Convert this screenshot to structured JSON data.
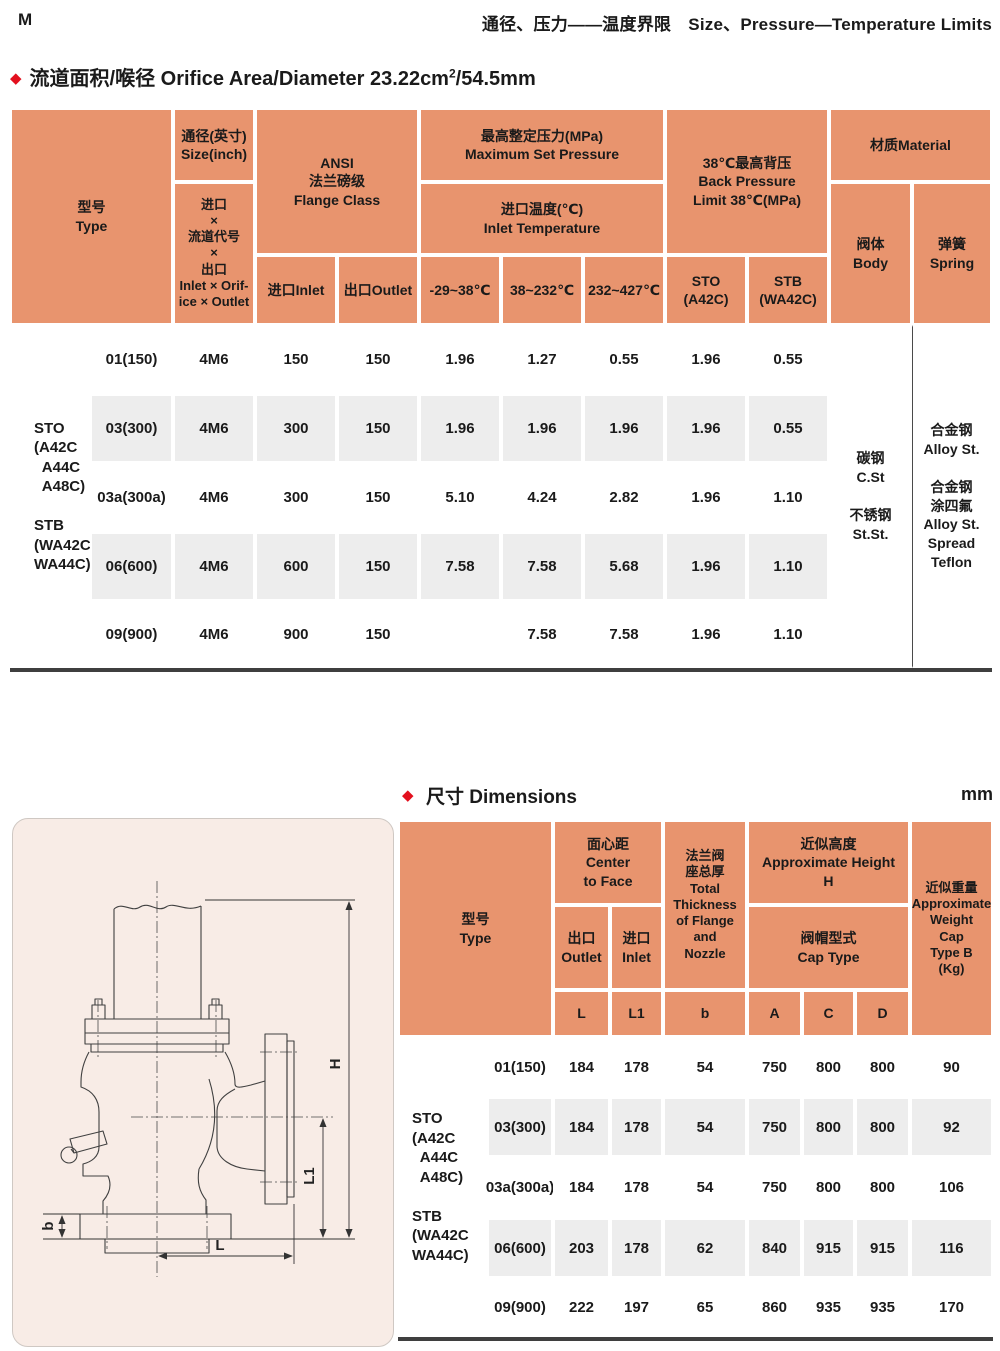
{
  "page": {
    "corner_mark": "M",
    "header_title": "通径、压力——温度界限　Size、Pressure—Temperature Limits"
  },
  "section1": {
    "title_main": "流道面积/喉径 Orifice Area/Diameter 23.22cm",
    "title_sup": "2",
    "title_suffix": "/54.5mm"
  },
  "section2": {
    "title": "尺寸 Dimensions",
    "unit": "mm"
  },
  "colors": {
    "table_header_bg": "#e8946e",
    "row_stripe": "#ededed",
    "accent_red": "#e3101e",
    "panel_bg": "#f8ece6",
    "rule_dark": "#3f3f3f"
  },
  "table1": {
    "headers": {
      "type": "型号\nType",
      "size_top": "通径(英寸)\nSize(inch)",
      "size_bottom": "进口\n×\n流道代号\n×\n出口\nInlet × Orif-\nice × Outlet",
      "ansi": "ANSI\n法兰磅级\nFlange Class",
      "inlet": "进口Inlet",
      "outlet": "出口Outlet",
      "max_set": "最高整定压力(MPa)\nMaximum Set Pressure",
      "inlet_temp": "进口温度(℃)\nInlet Temperature",
      "temp1": "-29~38℃",
      "temp2": "38~232℃",
      "temp3": "232~427℃",
      "back_pressure": "38℃最高背压\nBack Pressure\nLimit 38℃(MPa)",
      "sto": "STO\n(A42C)",
      "stb": "STB\n(WA42C)",
      "material": "材质Material",
      "body": "阀体\nBody",
      "spring": "弹簧\nSpring"
    },
    "side_label": "STO\n(A42C\n  A44C\n  A48C)\n\nSTB\n(WA42C\nWA44C)",
    "body_material": "碳钢\nC.St\n\n不锈钢\nSt.St.",
    "spring_material": "合金钢\nAlloy St.\n\n合金钢\n涂四氟\nAlloy St.\nSpread\nTeflon",
    "rows": [
      {
        "type": "01(150)",
        "size": "4M6",
        "inlet": "150",
        "outlet": "150",
        "t1": "1.96",
        "t2": "1.27",
        "t3": "0.55",
        "sto": "1.96",
        "stb": "0.55"
      },
      {
        "type": "03(300)",
        "size": "4M6",
        "inlet": "300",
        "outlet": "150",
        "t1": "1.96",
        "t2": "1.96",
        "t3": "1.96",
        "sto": "1.96",
        "stb": "0.55"
      },
      {
        "type": "03a(300a)",
        "size": "4M6",
        "inlet": "300",
        "outlet": "150",
        "t1": "5.10",
        "t2": "4.24",
        "t3": "2.82",
        "sto": "1.96",
        "stb": "1.10"
      },
      {
        "type": "06(600)",
        "size": "4M6",
        "inlet": "600",
        "outlet": "150",
        "t1": "7.58",
        "t2": "7.58",
        "t3": "5.68",
        "sto": "1.96",
        "stb": "1.10"
      },
      {
        "type": "09(900)",
        "size": "4M6",
        "inlet": "900",
        "outlet": "150",
        "t1": "",
        "t2": "7.58",
        "t3": "7.58",
        "sto": "1.96",
        "stb": "1.10"
      }
    ]
  },
  "table2": {
    "headers": {
      "type": "型号\nType",
      "center_to_face": "面心距\nCenter\nto Face",
      "outlet": "出口\nOutlet",
      "inlet": "进口\nInlet",
      "thickness": "法兰阀\n座总厚\nTotal\nThickness\nof Flange\nand\nNozzle",
      "approx_height": "近似高度\nApproximate Height\nH",
      "cap_type": "阀帽型式\nCap Type",
      "L": "L",
      "L1": "L1",
      "b": "b",
      "A": "A",
      "C": "C",
      "D": "D",
      "weight": "近似重量\nApproximate\nWeight\nCap\nType B\n(Kg)"
    },
    "side_label": "STO\n(A42C\n  A44C\n  A48C)\n\nSTB\n(WA42C\nWA44C)",
    "rows": [
      {
        "type": "01(150)",
        "L": "184",
        "L1": "178",
        "b": "54",
        "A": "750",
        "C": "800",
        "D": "800",
        "W": "90"
      },
      {
        "type": "03(300)",
        "L": "184",
        "L1": "178",
        "b": "54",
        "A": "750",
        "C": "800",
        "D": "800",
        "W": "92"
      },
      {
        "type": "03a(300a)",
        "L": "184",
        "L1": "178",
        "b": "54",
        "A": "750",
        "C": "800",
        "D": "800",
        "W": "106"
      },
      {
        "type": "06(600)",
        "L": "203",
        "L1": "178",
        "b": "62",
        "A": "840",
        "C": "915",
        "D": "915",
        "W": "116"
      },
      {
        "type": "09(900)",
        "L": "222",
        "L1": "197",
        "b": "65",
        "A": "860",
        "C": "935",
        "D": "935",
        "W": "170"
      }
    ]
  },
  "diagram": {
    "h": "H",
    "l1": "L1",
    "b": "b",
    "l": "L"
  }
}
